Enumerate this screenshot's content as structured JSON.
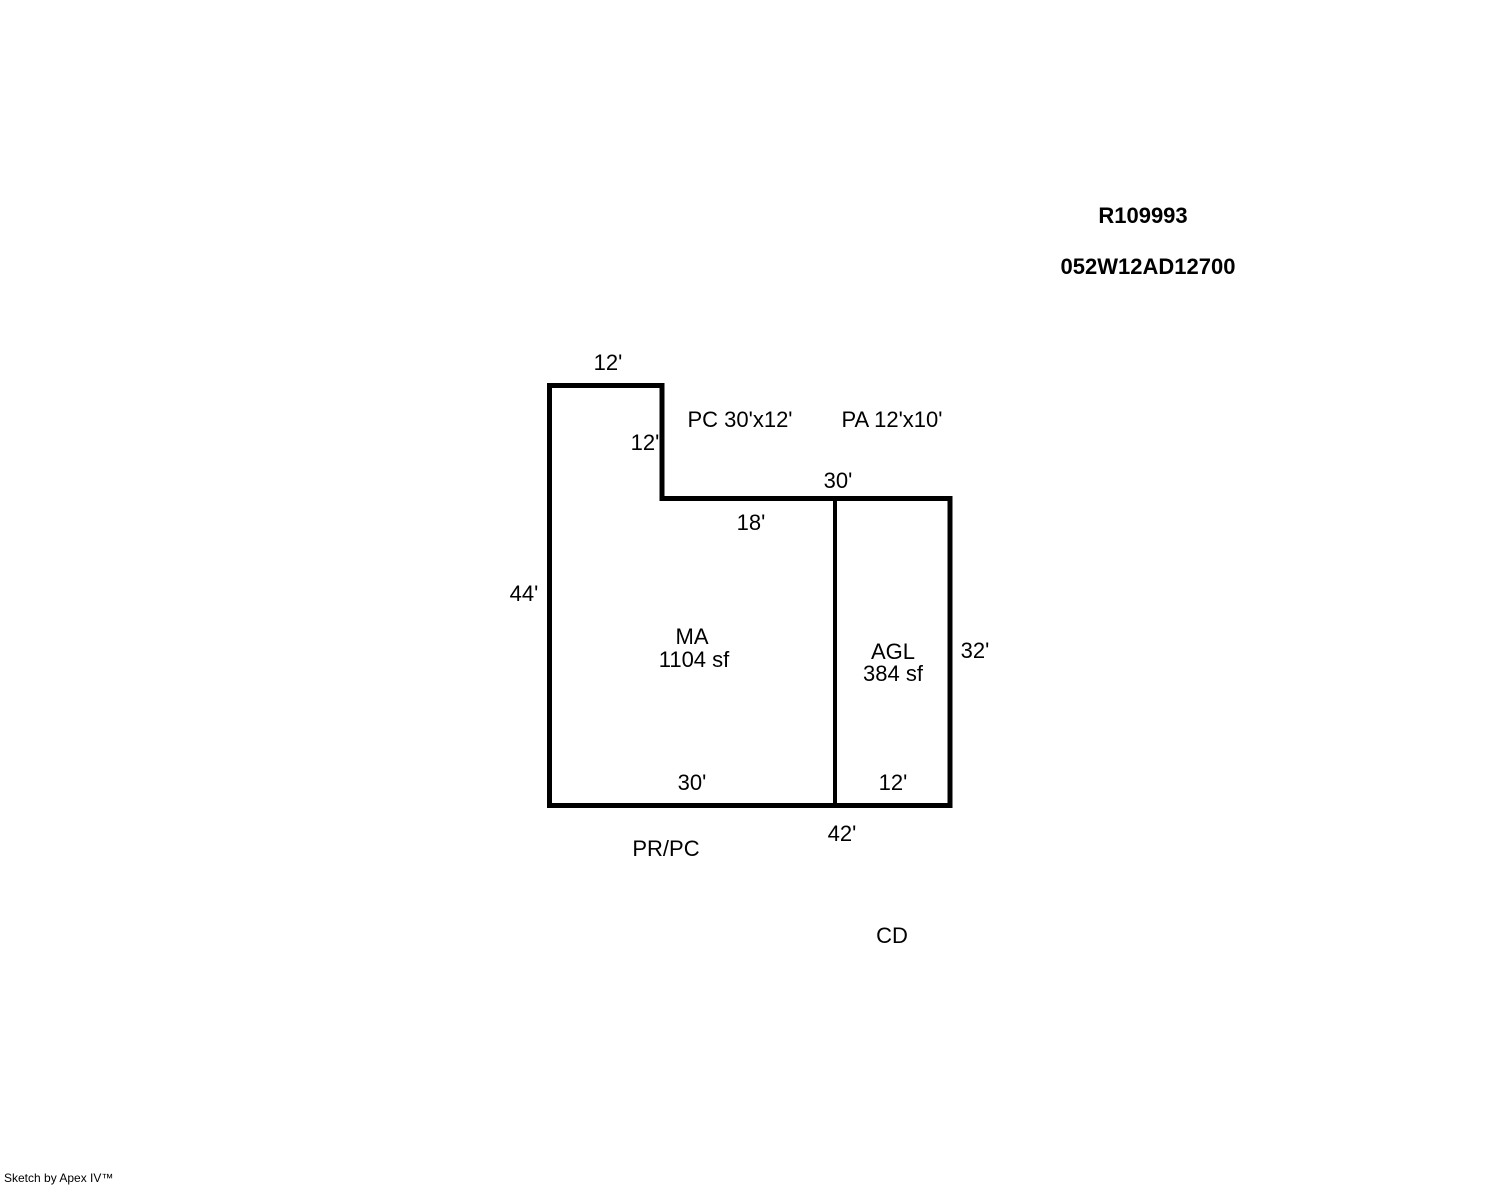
{
  "page": {
    "background_color": "#ffffff",
    "line_color": "#000000",
    "text_color": "#000000"
  },
  "header": {
    "record_number": "R109993",
    "parcel_number": "052W12AD12700"
  },
  "sketch": {
    "dimensions": {
      "top_width": "12'",
      "notch_height": "12'",
      "upper_width": "30'",
      "mid_width": "18'",
      "left_height": "44'",
      "right_height": "32'",
      "bottom_main_width": "30'",
      "bottom_garage_width": "12'",
      "bottom_total_width": "42'"
    },
    "areas": {
      "main": {
        "code": "MA",
        "size": "1104 sf"
      },
      "garage": {
        "code": "AGL",
        "size": "384 sf"
      }
    },
    "annotations": {
      "pc": "PC 30'x12'",
      "pa": "PA 12'x10'",
      "pr_pc": "PR/PC",
      "cd": "CD"
    }
  },
  "footer": {
    "credit": "Sketch by Apex IV™"
  }
}
